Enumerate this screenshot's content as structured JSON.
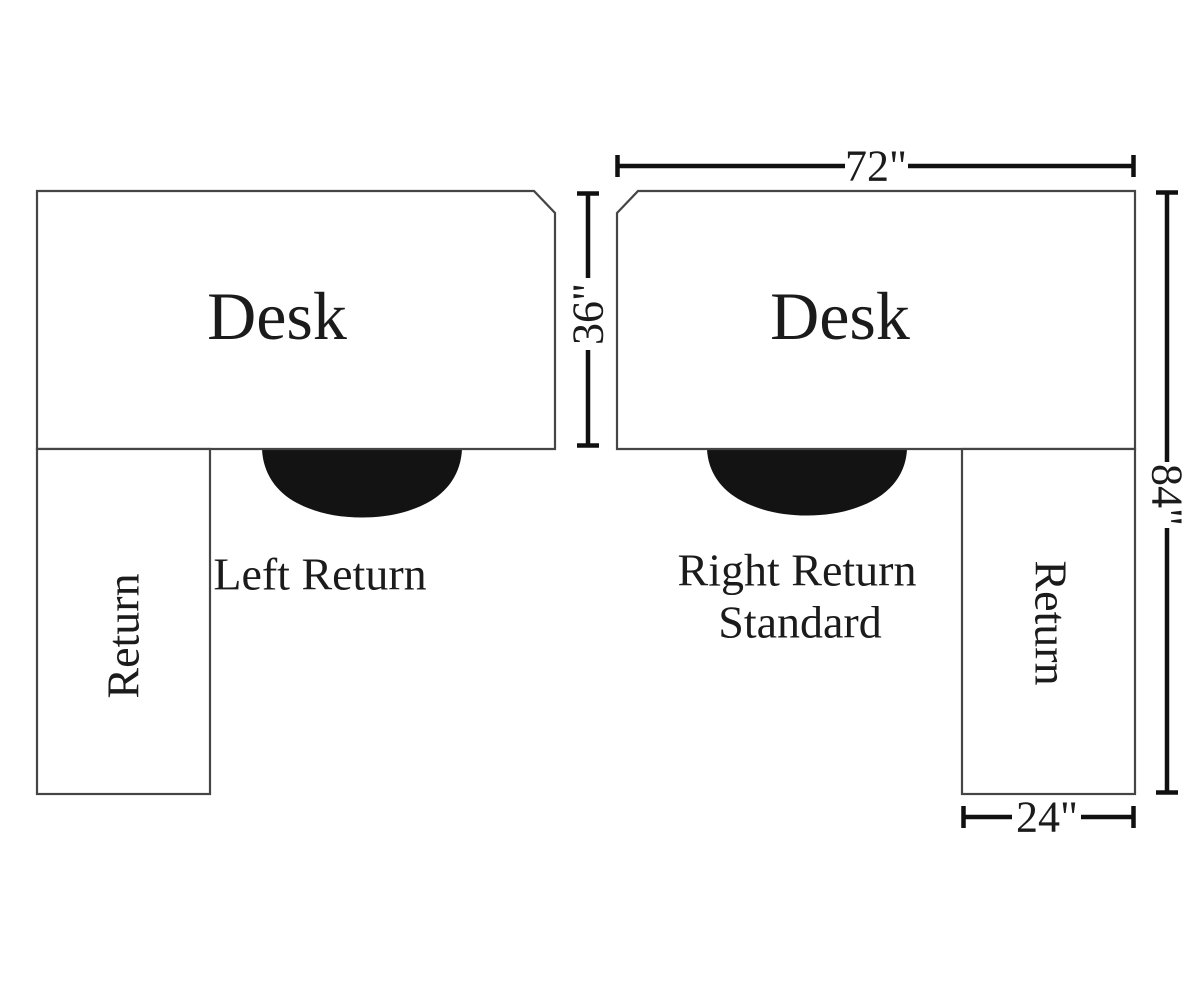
{
  "diagram": {
    "background": "#ffffff",
    "outline_color": "#454545",
    "dimension_color": "#101010",
    "chair_color": "#131313",
    "text_color": "#1b1b1b",
    "left_unit": {
      "desk_label": "Desk",
      "return_label": "Return",
      "caption": "Left Return"
    },
    "right_unit": {
      "desk_label": "Desk",
      "return_label": "Return",
      "caption_line1": "Right Return",
      "caption_line2": "Standard"
    },
    "dimensions": {
      "desk_width": "72\"",
      "desk_depth": "36\"",
      "overall_depth": "84\"",
      "return_width": "24\""
    }
  }
}
